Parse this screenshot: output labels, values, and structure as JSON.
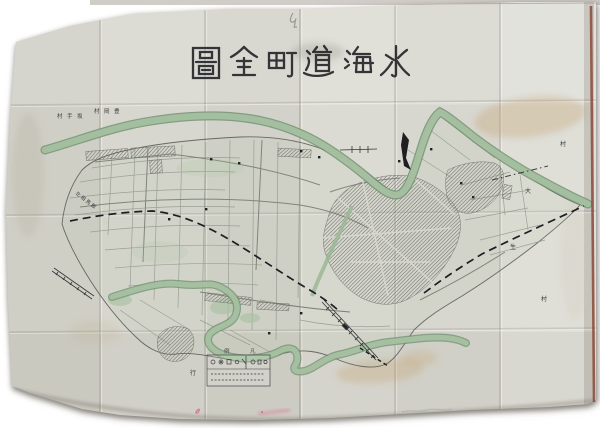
{
  "photo": {
    "background_color": "#ffffff",
    "paper_color": "#d8d7cf",
    "right_edge_color": "#8a4a3a",
    "pink_mark_color": "#e0557e"
  },
  "map": {
    "title_display": "圖全町道海水",
    "title_reading": "水海道町全圖",
    "ink_color": "#26262b",
    "river_color": "#a6c1a1",
    "river_edge_color": "#6e8f6e"
  },
  "labels": {
    "north_bank_village_left": "村手坂",
    "north_bank_village_left_reading": "坂手村",
    "north_bank_village_right": "村岡豊",
    "north_bank_village_right_reading": "豊岡村",
    "southwest_district": "北相馬郡",
    "east_village": "村",
    "east_char_upper": "大",
    "east_char_lower": "生",
    "southeast_village": "村",
    "south_char": "行",
    "legend_char_left": "例",
    "legend_char_right": "凡",
    "legend_title_reading": "凡例"
  }
}
